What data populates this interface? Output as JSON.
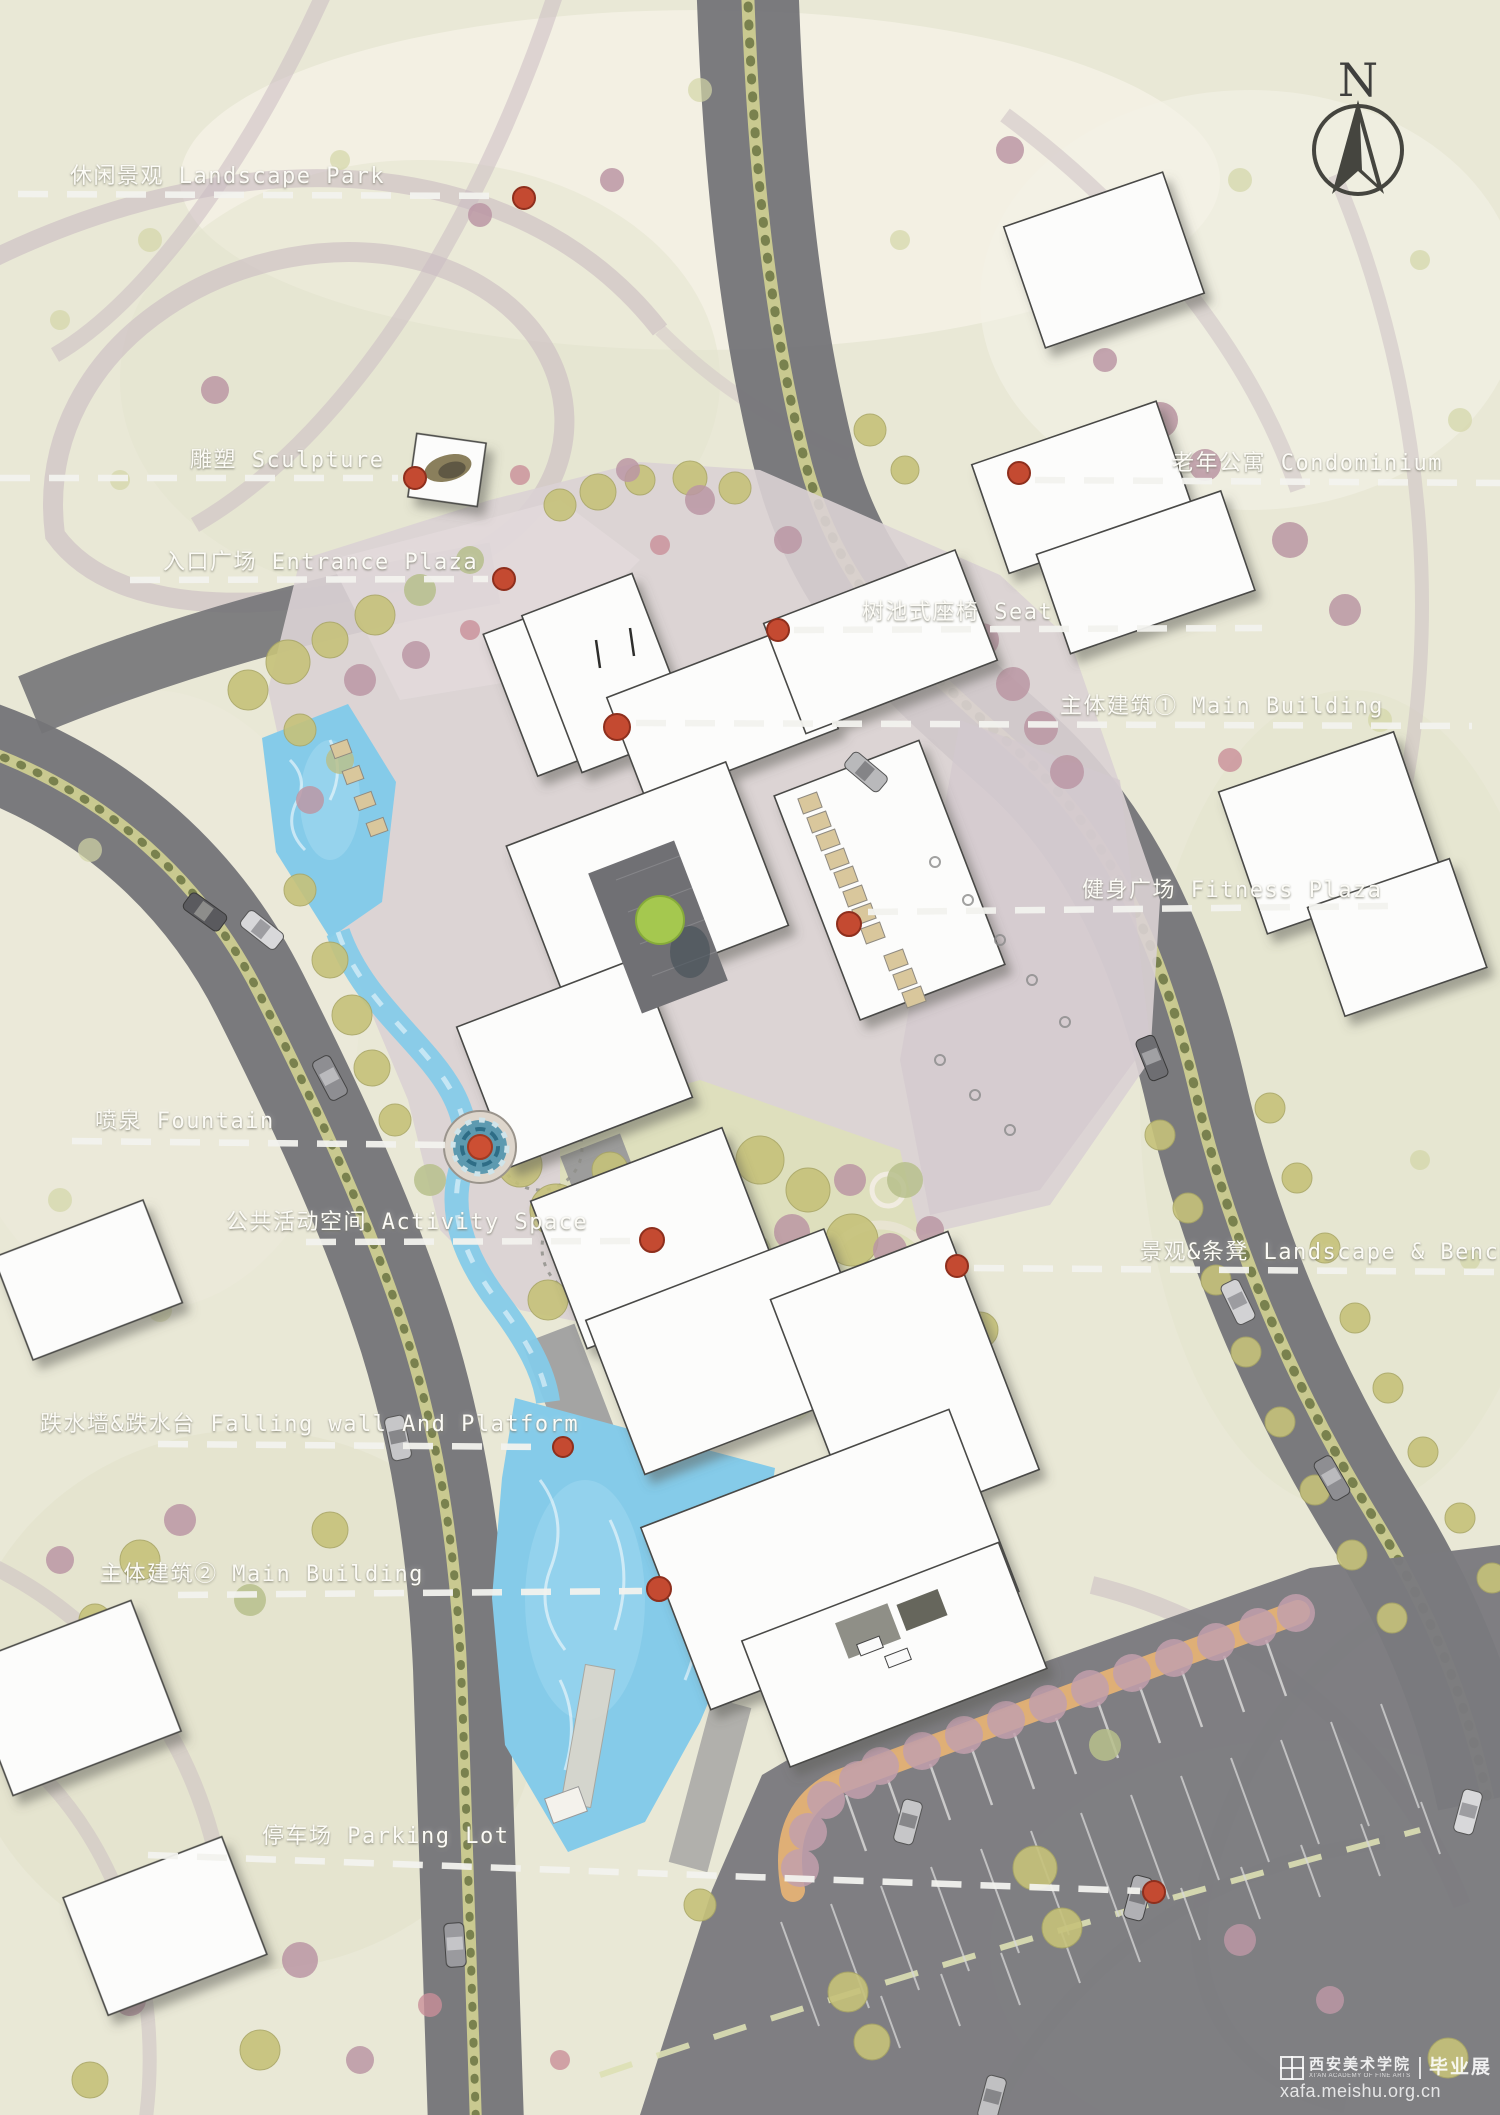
{
  "compass": {
    "north_label": "N"
  },
  "annotations": [
    {
      "id": "landscape-park",
      "text": "休闲景观 Landscape Park"
    },
    {
      "id": "sculpture",
      "text": "雕塑 Sculpture"
    },
    {
      "id": "entrance-plaza",
      "text": "入口广场 Entrance Plaza"
    },
    {
      "id": "tree-pool-seat",
      "text": "树池式座椅 Seat"
    },
    {
      "id": "senior-condominium",
      "text": "老年公寓 Condominium"
    },
    {
      "id": "main-building-1",
      "text": "主体建筑① Main Building"
    },
    {
      "id": "fitness-plaza",
      "text": "健身广场 Fitness Plaza"
    },
    {
      "id": "fountain",
      "text": "喷泉 Fountain"
    },
    {
      "id": "activity-space",
      "text": "公共活动空间 Activity Space"
    },
    {
      "id": "landscape-bench",
      "text": "景观&条凳 Landscape & Bench"
    },
    {
      "id": "falling-wall-platform",
      "text": "跌水墙&跌水台 Falling wall And Platform"
    },
    {
      "id": "main-building-2",
      "text": "主体建筑② Main Building"
    },
    {
      "id": "parking-lot",
      "text": "停车场 Parking Lot"
    }
  ],
  "watermark": {
    "school": "西安美术学院",
    "school_sub": "XI'AN ACADEMY OF FINE ARTS",
    "exhibition": "毕业展",
    "site": "xafa.meishu.org.cn"
  },
  "colors": {
    "paper": "#e9e8d6",
    "road": "#747478",
    "road_median": "#c9c990",
    "plaza_paving": "#dad1d4",
    "water": "#85cbe9",
    "building": "#fcfcfb",
    "marker_red": "#c44a31",
    "leader_white": "#f3f3ef",
    "canopy_orange": "#eab574",
    "tree_olive": "#c6c27a",
    "tree_mauve": "#bb97a4"
  }
}
